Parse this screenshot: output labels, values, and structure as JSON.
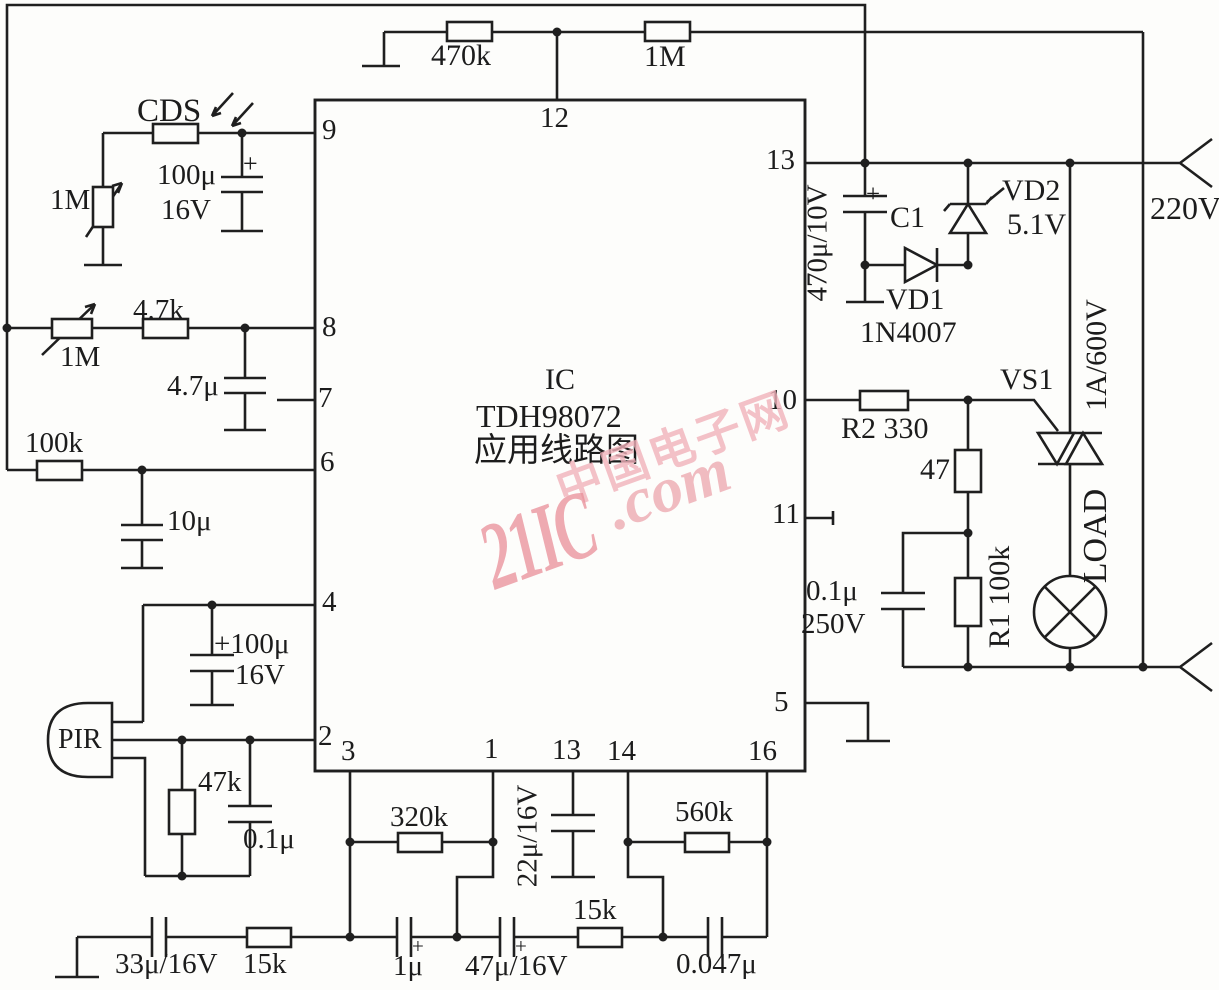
{
  "ic": {
    "label": "IC",
    "part": "TDH98072",
    "caption": "应用线路图",
    "pins": {
      "p9": "9",
      "p8": "8",
      "p7": "7",
      "p6": "6",
      "p4": "4",
      "p2": "2",
      "p12": "12",
      "p13_right": "13",
      "p10": "10",
      "p11": "11",
      "p5": "5",
      "p3": "3",
      "p1": "1",
      "p13_bottom": "13",
      "p14": "14",
      "p16": "16"
    }
  },
  "power": {
    "mains": "220V"
  },
  "sensors": {
    "cds": "CDS",
    "pir": "PIR"
  },
  "resistors": {
    "r470k": "470k",
    "r1m_top": "1M",
    "pot1m_left": "1M",
    "pot1m_mid": "1M",
    "r4k7": "4.7k",
    "r100k_left": "100k",
    "r47k": "47k",
    "r320k": "320k",
    "r560k": "560k",
    "r15k_left": "15k",
    "r15k_mid": "15k",
    "r2": "R2 330",
    "r47": "47",
    "r1": "R1 100k"
  },
  "capacitors": {
    "c100u_top": "100μ",
    "c100u_top_v": "16V",
    "c4u7": "4.7μ",
    "c10u": "10μ",
    "c100u_bot": "+100μ",
    "c100u_bot_v": "16V",
    "c0u1_pir": "0.1μ",
    "c470u": "470μ/10V",
    "c1": "C1",
    "c0u1_snub": "0.1μ",
    "c0u1_snub_v": "250V",
    "c22u": "22μ/16V",
    "c33u": "33μ/16V",
    "c1u": "1μ",
    "c47u": "47μ/16V",
    "c0047u": "0.047μ",
    "plus": "+"
  },
  "semis": {
    "vd1": "VD1",
    "vd1_part": "1N4007",
    "vd2": "VD2",
    "vd2_v": "5.1V",
    "vs1": "VS1",
    "vs1_rating": "1A/600V",
    "load": "LOAD"
  },
  "watermark": {
    "brand": "21IC",
    "suffix": ".com",
    "cn": "中国电子网"
  }
}
